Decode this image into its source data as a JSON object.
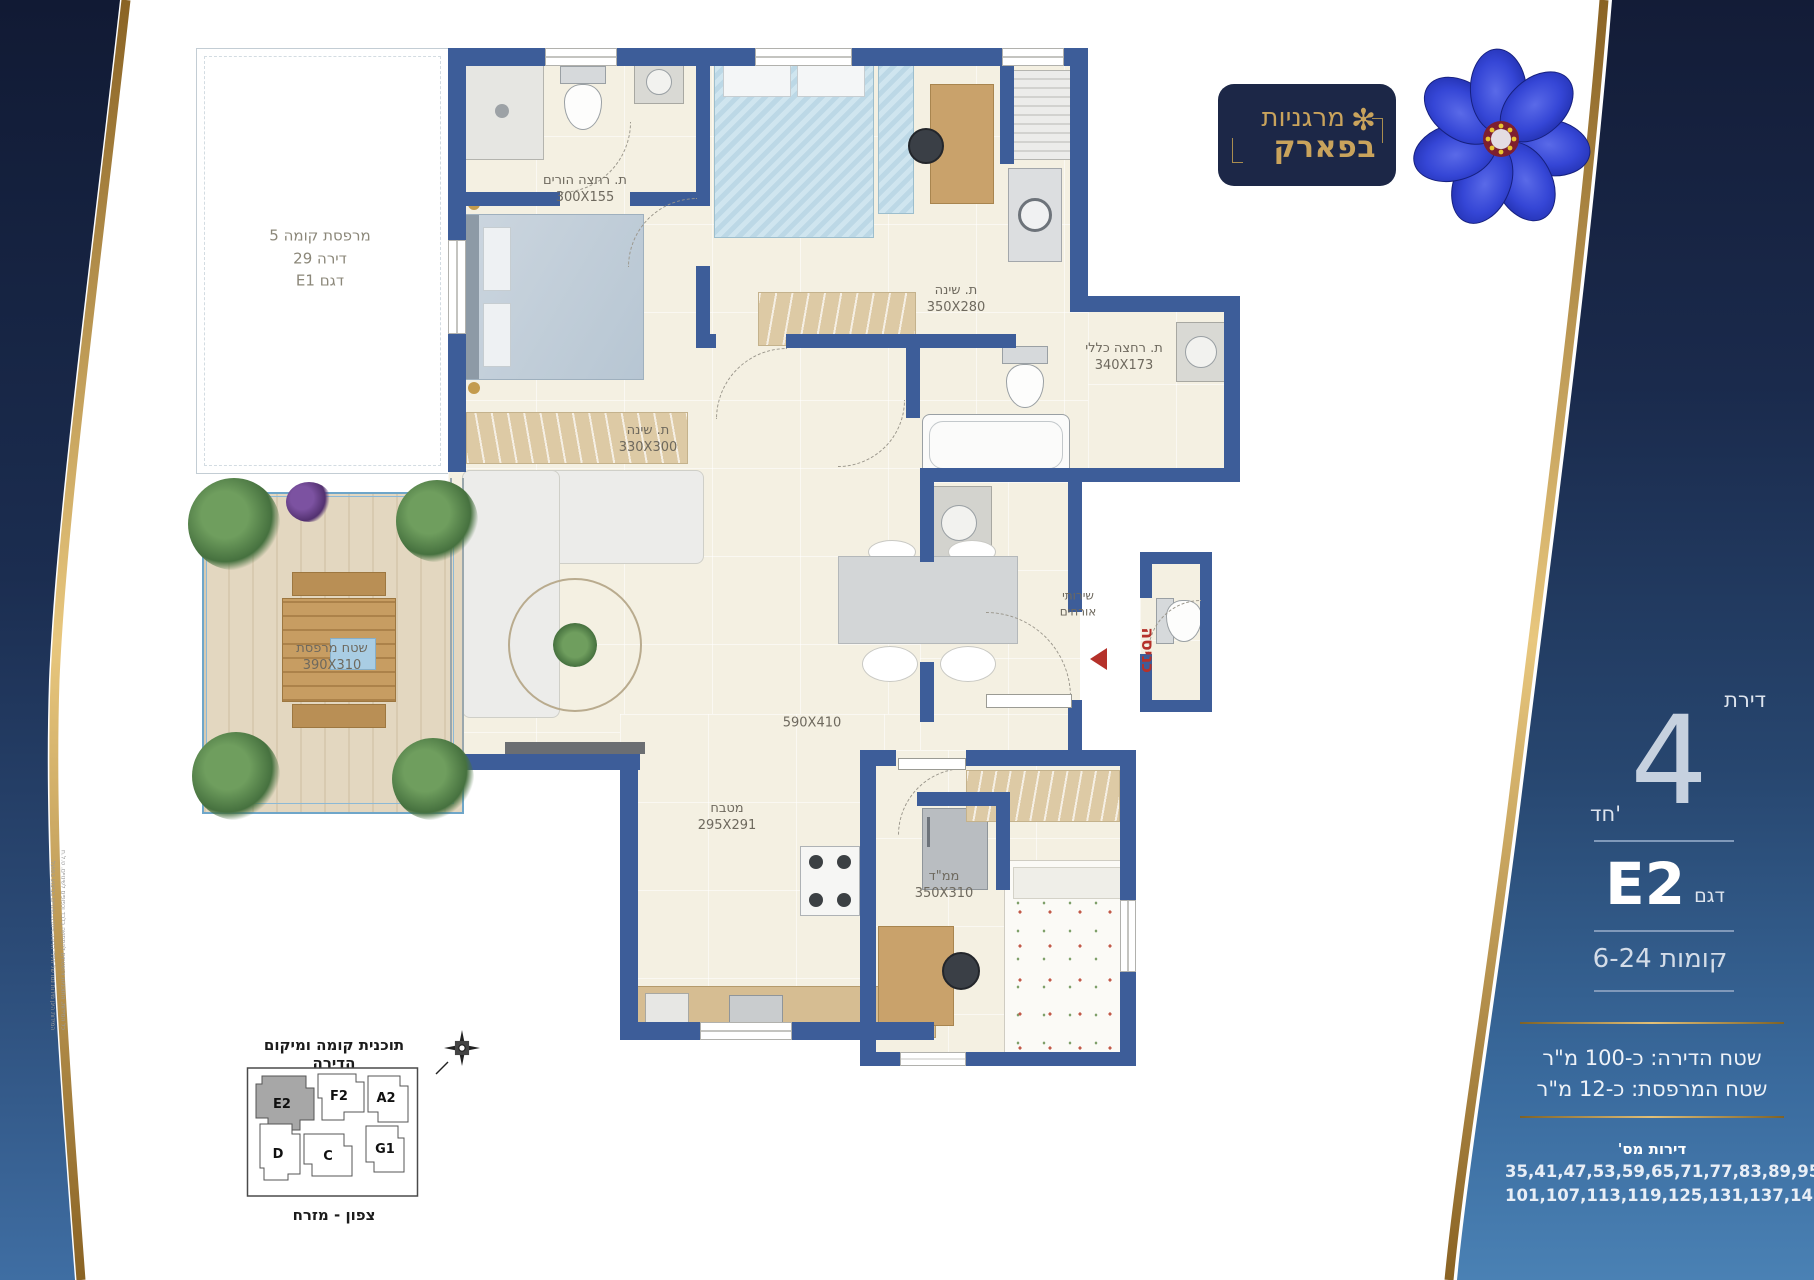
{
  "brand": {
    "name_line1": "מרגניות",
    "name_line2": "בפארק"
  },
  "panel": {
    "apartment_word": "דירת",
    "rooms_number": "4",
    "rooms_suffix": "חד'",
    "model_word": "דגם",
    "model_number": "E2",
    "floors_line": "קומות 6-24",
    "area_apartment": "שטח הדירה:  כ-100 מ\"ר",
    "area_balcony": "שטח המרפסת:  כ-12 מ\"ר",
    "apartments_title": "דירות מס'",
    "apartments_line1": "35,41,47,53,59,65,71,77,83,89,95",
    "apartments_line2": "101,107,113,119,125,131,137,143"
  },
  "floorplan": {
    "upper_balcony": {
      "line1": "מרפסת קומה 5",
      "line2": "דירה 29",
      "line3": "דגם E1"
    },
    "rooms": {
      "bath_parents": {
        "name": "ת. רחצה הורים",
        "dims": "300X155"
      },
      "bedroom_top": {
        "name": "ת. שינה",
        "dims": "350X280"
      },
      "bedroom_left": {
        "name": "ת. שינה",
        "dims": "330X300"
      },
      "bath_general": {
        "name": "ת. רחצה כללי",
        "dims": "340X173"
      },
      "guest_wc": {
        "name_line1": "שירותי",
        "name_line2": "אורחים"
      },
      "living": {
        "dims": "590X410"
      },
      "kitchen": {
        "name": "מטבח",
        "dims": "295X291"
      },
      "mamad": {
        "name": "ממ\"ד",
        "dims": "350X310"
      },
      "balcony": {
        "name": "שטח מרפסת",
        "dims": "390X310"
      }
    },
    "entrance_label": "כניסה"
  },
  "keyplan": {
    "title": "תוכנית קומה ומיקום הדירה",
    "caption": "צפון - מזרח",
    "units": {
      "e2": "E2",
      "f2": "F2",
      "a2": "A2",
      "d": "D",
      "c": "C",
      "g1": "G1"
    }
  },
  "disclaimer": {
    "line1": "כל המידות, התוכניות והשטחים להמחשה בלבד וכפופים לשינויים. ט.ל.ח",
    "line2": "המידות הינן מידות נטו של חללי הדירה וייתכנו שינויים בביצוע בפועל."
  }
}
